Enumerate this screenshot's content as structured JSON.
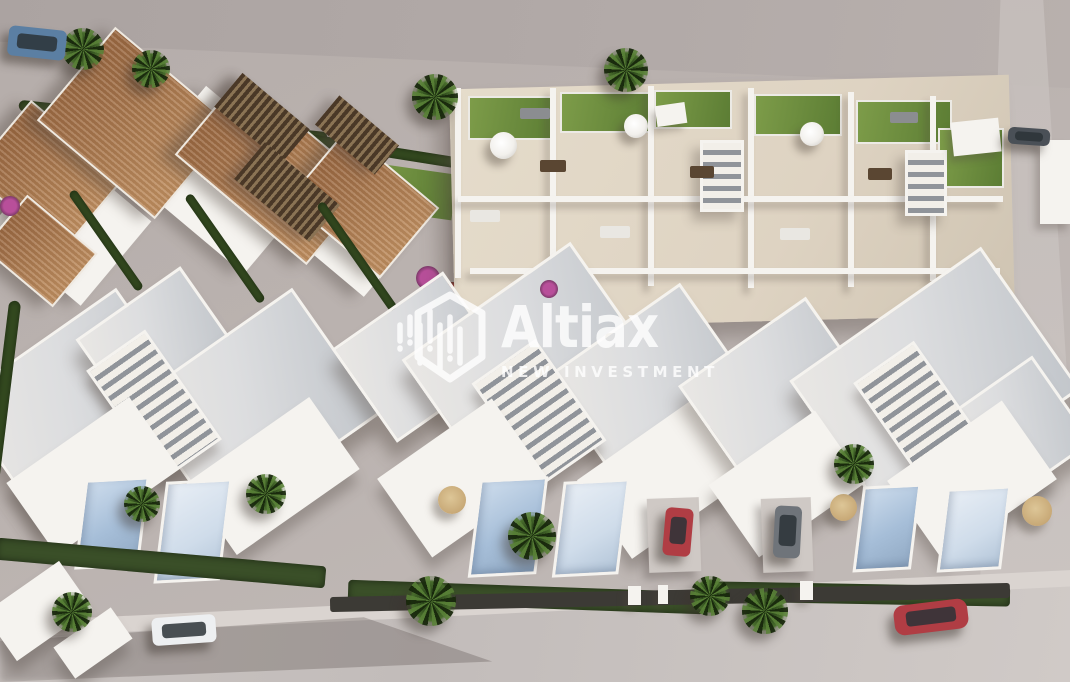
{
  "image": {
    "type": "architectural-aerial-render",
    "description": "Aerial 3D rendering of a new-build residential development: modern white villas with private pools and roof terraces, rooftop-terrace townhouses, Mediterranean tiled-roof houses, palm trees, hedges and parked cars along surrounding streets"
  },
  "watermark": {
    "brand": "Altiax",
    "tagline": "NEW INVESTMENT",
    "logo_icon": "hexagon-equalizer-icon"
  },
  "scene": {
    "cars": [
      {
        "name": "blue-suv-top-left",
        "color_key": "car_blue"
      },
      {
        "name": "red-car-driveway",
        "color_key": "car_red"
      },
      {
        "name": "gray-car-driveway",
        "color_key": "car_gray"
      },
      {
        "name": "white-car-road",
        "color_key": "car_white"
      },
      {
        "name": "red-car-road",
        "color_key": "car_red"
      },
      {
        "name": "dark-car-side-street",
        "color_key": "car_dark"
      }
    ],
    "features": [
      "white-villas-with-pools",
      "rooftop-terrace-townhouses",
      "tiled-roof-houses",
      "private-pools",
      "palm-trees",
      "garden-hedges",
      "sun-umbrellas",
      "streets-with-parked-cars"
    ]
  },
  "palette": {
    "ground": "#b5adaa",
    "ground_light": "#c3bcb9",
    "road": "#cbc5c2",
    "sidewalk": "#dad4d0",
    "building_white": "#f5f3ef",
    "roof_light": "#dcdddf",
    "roof_shade": "#c2c6cb",
    "tile_roof": "#9c6a43",
    "tile_roof_light": "#bd8c5e",
    "pergola_dark": "#4a3827",
    "pergola_light": "#8a7354",
    "terrace_floor": "#ded3c2",
    "lawn": "#7d9c49",
    "lawn_dark": "#5c7d34",
    "hedge": "#33491f",
    "garden_dark": "#3a4f28",
    "palm": "#4d7230",
    "palm_dark": "#2c461c",
    "pool": "#a6bed8",
    "pool_light": "#cfdcea",
    "flower_magenta": "#b84f9a",
    "flower_red": "#a43b35",
    "car_blue": "#5b7fa3",
    "car_red": "#b03d44",
    "car_white": "#edeff1",
    "car_gray": "#6f747a",
    "car_dark": "#4a5057",
    "umbrella_white": "#f2f0ec",
    "umbrella_straw": "#c8a977",
    "watermark_white": "#ffffff"
  }
}
